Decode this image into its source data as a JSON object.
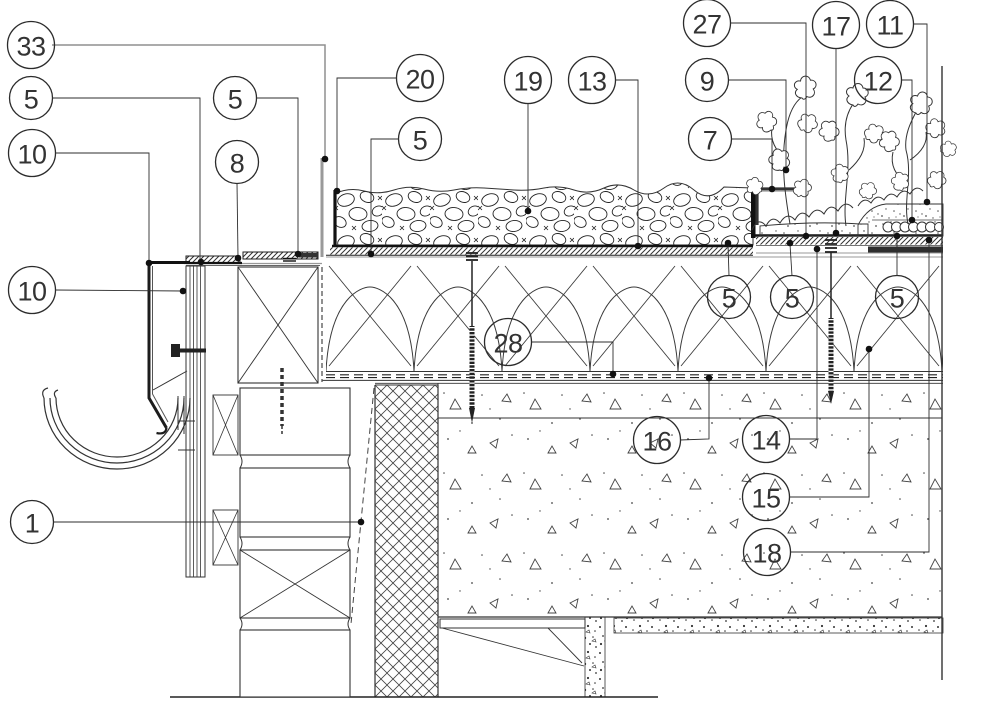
{
  "figure": {
    "kind": "architectural-construction-detail",
    "background": "#ffffff"
  },
  "style": {
    "line_color": "#2b2b2b",
    "leader_color": "#2e2e2e",
    "muted_leader_color": "#8f8f8f",
    "dot_color": "#111111",
    "circle_stroke": "#2b2b2b",
    "text_color": "#333333"
  },
  "callouts": [
    {
      "label": "33",
      "cx": 31,
      "cy": 45,
      "leader": [
        [
          52,
          45
        ],
        [
          325,
          45
        ],
        [
          325,
          159
        ]
      ],
      "dot": [
        325,
        159
      ],
      "muted": true
    },
    {
      "label": "5",
      "cx": 31,
      "cy": 98,
      "leader": [
        [
          52,
          98
        ],
        [
          200,
          98
        ],
        [
          200,
          261
        ]
      ],
      "dot": [
        201,
        262
      ],
      "muted": false
    },
    {
      "label": "10",
      "cx": 32,
      "cy": 153,
      "leader": [
        [
          55,
          153
        ],
        [
          149,
          153
        ],
        [
          149,
          262
        ]
      ],
      "dot": [
        149,
        263
      ],
      "muted": false
    },
    {
      "label": "10",
      "cx": 32,
      "cy": 290,
      "leader": [
        [
          55,
          290
        ],
        [
          183,
          291
        ]
      ],
      "dot": [
        183,
        291
      ],
      "muted": false
    },
    {
      "label": "1",
      "cx": 32,
      "cy": 522,
      "leader": [
        [
          53,
          522
        ],
        [
          361,
          522
        ]
      ],
      "dot": [
        361,
        522
      ],
      "muted": false
    },
    {
      "label": "5",
      "cx": 235,
      "cy": 98,
      "leader": [
        [
          256,
          98
        ],
        [
          298,
          98
        ],
        [
          298,
          253
        ]
      ],
      "dot": [
        298,
        254
      ],
      "muted": false
    },
    {
      "label": "8",
      "cx": 237,
      "cy": 162,
      "leader": [
        [
          237,
          183
        ],
        [
          238,
          257
        ]
      ],
      "dot": [
        238,
        258
      ],
      "muted": false
    },
    {
      "label": "20",
      "cx": 420,
      "cy": 78,
      "leader": [
        [
          397,
          78
        ],
        [
          337,
          78
        ],
        [
          337,
          190
        ]
      ],
      "dot": [
        337,
        191
      ],
      "muted": false
    },
    {
      "label": "5",
      "cx": 420,
      "cy": 139,
      "leader": [
        [
          399,
          139
        ],
        [
          371,
          139
        ],
        [
          371,
          253
        ]
      ],
      "dot": [
        371,
        254
      ],
      "muted": false
    },
    {
      "label": "19",
      "cx": 528,
      "cy": 80,
      "leader": [
        [
          528,
          103
        ],
        [
          528,
          210
        ]
      ],
      "dot": [
        528,
        211
      ],
      "muted": false
    },
    {
      "label": "13",
      "cx": 592,
      "cy": 80,
      "leader": [
        [
          615,
          80
        ],
        [
          638,
          80
        ],
        [
          638,
          245
        ]
      ],
      "dot": [
        638,
        246
      ],
      "muted": false
    },
    {
      "label": "28",
      "cx": 508,
      "cy": 342,
      "leader": [
        [
          531,
          342
        ],
        [
          613,
          342
        ],
        [
          613,
          373
        ]
      ],
      "dot": [
        613,
        374
      ],
      "muted": false
    },
    {
      "label": "27",
      "cx": 707,
      "cy": 23,
      "leader": [
        [
          730,
          23
        ],
        [
          806,
          23
        ],
        [
          806,
          235
        ]
      ],
      "dot": [
        806,
        236
      ],
      "muted": false
    },
    {
      "label": "9",
      "cx": 707,
      "cy": 80,
      "leader": [
        [
          728,
          80
        ],
        [
          786,
          80
        ],
        [
          786,
          169
        ]
      ],
      "dot": [
        786,
        170
      ],
      "muted": false
    },
    {
      "label": "7",
      "cx": 710,
      "cy": 139,
      "leader": [
        [
          731,
          139
        ],
        [
          772,
          139
        ],
        [
          772,
          188
        ]
      ],
      "dot": [
        772,
        189
      ],
      "muted": false
    },
    {
      "label": "17",
      "cx": 836,
      "cy": 25,
      "leader": [
        [
          836,
          48
        ],
        [
          836,
          232
        ]
      ],
      "dot": [
        836,
        233
      ],
      "muted": false
    },
    {
      "label": "11",
      "cx": 890,
      "cy": 24,
      "leader": [
        [
          913,
          24
        ],
        [
          927,
          24
        ],
        [
          927,
          201
        ]
      ],
      "dot": [
        927,
        202
      ],
      "muted": false
    },
    {
      "label": "12",
      "cx": 878,
      "cy": 80,
      "leader": [
        [
          901,
          80
        ],
        [
          912,
          80
        ],
        [
          912,
          219
        ]
      ],
      "dot": [
        912,
        220
      ],
      "muted": false
    },
    {
      "label": "5",
      "cx": 729,
      "cy": 297,
      "leader": [
        [
          729,
          276
        ],
        [
          728,
          244
        ]
      ],
      "dot": [
        728,
        243
      ],
      "muted": false
    },
    {
      "label": "5",
      "cx": 792,
      "cy": 297,
      "leader": [
        [
          792,
          276
        ],
        [
          790,
          244
        ]
      ],
      "dot": [
        790,
        243
      ],
      "muted": false
    },
    {
      "label": "5",
      "cx": 897,
      "cy": 297,
      "leader": [
        [
          897,
          276
        ],
        [
          897,
          237
        ]
      ],
      "dot": [
        897,
        236
      ],
      "muted": false
    },
    {
      "label": "16",
      "cx": 657,
      "cy": 440,
      "leader": [
        [
          680,
          440
        ],
        [
          709,
          439
        ],
        [
          709,
          379
        ]
      ],
      "dot": [
        709,
        378
      ],
      "muted": false
    },
    {
      "label": "14",
      "cx": 766,
      "cy": 439,
      "leader": [
        [
          789,
          439
        ],
        [
          817,
          439
        ],
        [
          817,
          250
        ]
      ],
      "dot": [
        817,
        249
      ],
      "muted": false
    },
    {
      "label": "15",
      "cx": 766,
      "cy": 497,
      "leader": [
        [
          789,
          497
        ],
        [
          869,
          497
        ],
        [
          869,
          350
        ]
      ],
      "dot": [
        869,
        349
      ],
      "muted": false
    },
    {
      "label": "18",
      "cx": 767,
      "cy": 552,
      "leader": [
        [
          790,
          552
        ],
        [
          929,
          552
        ],
        [
          929,
          241
        ]
      ],
      "dot": [
        929,
        240
      ],
      "muted": false
    }
  ]
}
